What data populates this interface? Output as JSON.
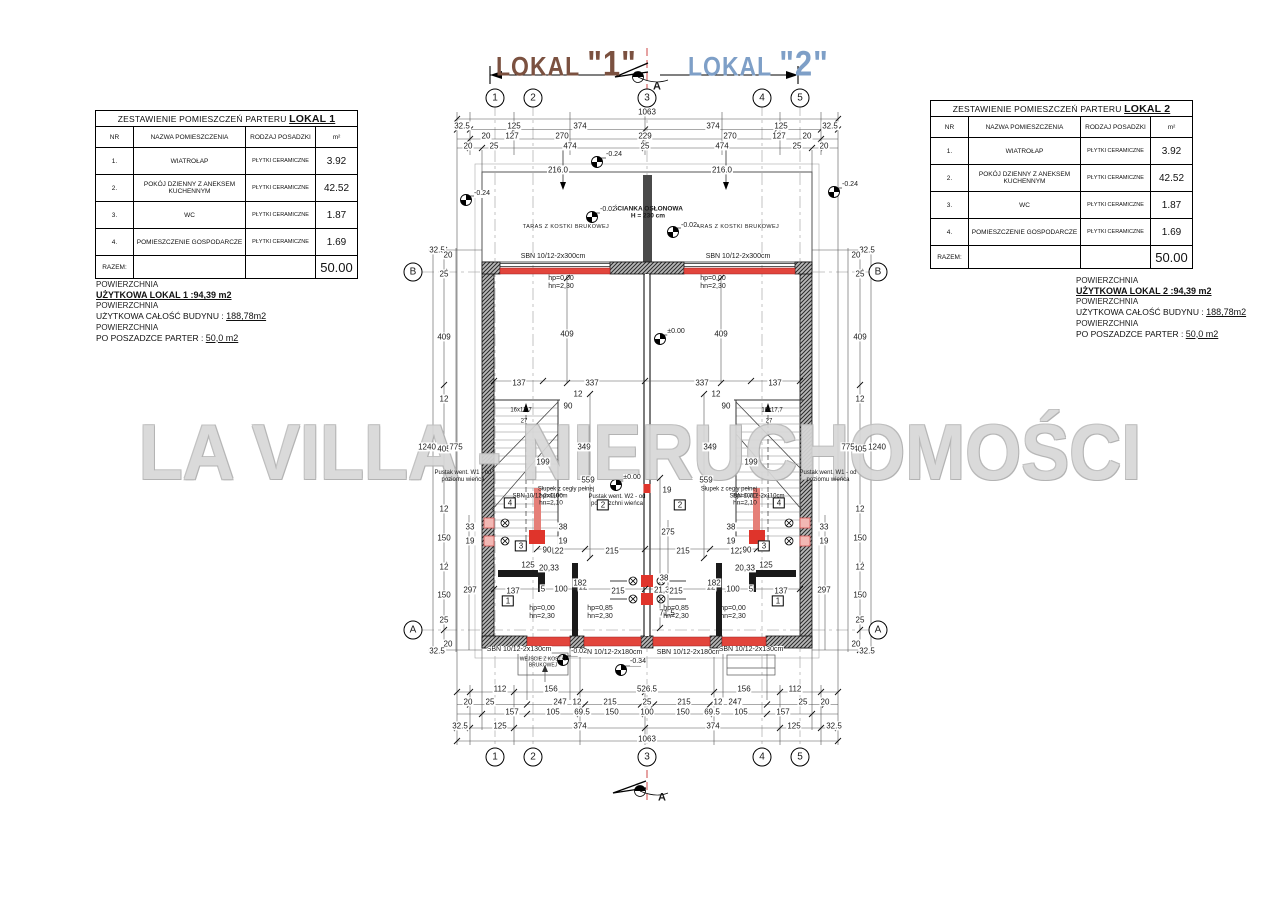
{
  "watermark": "LA VILLA - NIERUCHOMOŚCI",
  "colors": {
    "lokal1": "#7b5140",
    "lokal2": "#7e9fc7",
    "lintel_red": "#e2453c",
    "terrace_text": "#d9837d",
    "watermark_gray": "#d7d7d7"
  },
  "lokals": [
    {
      "prefix": "LOKAL",
      "num": "\"1\""
    },
    {
      "prefix": "LOKAL",
      "num": "\"2\""
    }
  ],
  "tables": [
    {
      "title": "ZESTAWIENIE POMIESZCZEŃ PARTERU ",
      "title_bold": "LOKAL 1",
      "headers": [
        "NR",
        "NAZWA POMIESZCZENIA",
        "RODZAJ POSADZKI",
        "m²"
      ],
      "rows": [
        [
          "1.",
          "WIATROŁAP",
          "PŁYTKI CERAMICZNE",
          "3.92"
        ],
        [
          "2.",
          "POKÓJ DZIENNY Z ANEKSEM KUCHENNYM",
          "PŁYTKI CERAMICZNE",
          "42.52"
        ],
        [
          "3.",
          "WC",
          "PŁYTKI CERAMICZNE",
          "1.87"
        ],
        [
          "4.",
          "POMIESZCZENIE GOSPODARCZE",
          "PŁYTKI CERAMICZNE",
          "1.69"
        ]
      ],
      "total_label": "RAZEM:",
      "total_value": "50.00"
    },
    {
      "title": "ZESTAWIENIE POMIESZCZEŃ PARTERU ",
      "title_bold": "LOKAL 2",
      "headers": [
        "NR",
        "NAZWA POMIESZCZENIA",
        "RODZAJ POSADZKI",
        "m²"
      ],
      "rows": [
        [
          "1.",
          "WIATROŁAP",
          "PŁYTKI CERAMICZNE",
          "3.92"
        ],
        [
          "2.",
          "POKÓJ DZIENNY Z ANEKSEM KUCHENNYM",
          "PŁYTKI CERAMICZNE",
          "42.52"
        ],
        [
          "3.",
          "WC",
          "PŁYTKI CERAMICZNE",
          "1.87"
        ],
        [
          "4.",
          "POMIESZCZENIE GOSPODARCZE",
          "PŁYTKI CERAMICZNE",
          "1.69"
        ]
      ],
      "total_label": "RAZEM:",
      "total_value": "50.00"
    }
  ],
  "notes": [
    {
      "p": "POWIERZCHNIA",
      "strong": "UŻYTKOWA LOKAL 1  :94,39 m2",
      "l2": "UŻYTKOWA CAŁOŚĆ BUDYNU :",
      "v2": "188,78m2",
      "l3": "PO POSZADZCE PARTER :",
      "v3": "50,0 m2"
    },
    {
      "p": "POWIERZCHNIA",
      "strong": "UŻYTKOWA LOKAL 2  :94,39 m2",
      "l2": "UŻYTKOWA CAŁOŚĆ BUDYNU :",
      "v2": "188,78m2",
      "l3": "PO POSZADZCE PARTER :",
      "v3": "50,0 m2"
    }
  ],
  "plan": {
    "labels": [
      [
        647,
        112,
        "1063",
        "d"
      ],
      [
        462,
        126,
        "32.5",
        "d"
      ],
      [
        514,
        126,
        "125",
        "d"
      ],
      [
        580,
        126,
        "374",
        "d"
      ],
      [
        713,
        126,
        "374",
        "d"
      ],
      [
        781,
        126,
        "125",
        "d"
      ],
      [
        830,
        126,
        "32.5",
        "d"
      ],
      [
        486,
        136,
        "20",
        "d"
      ],
      [
        512,
        136,
        "127",
        "d"
      ],
      [
        562,
        136,
        "270",
        "d"
      ],
      [
        645,
        136,
        "229",
        "d"
      ],
      [
        730,
        136,
        "270",
        "d"
      ],
      [
        779,
        136,
        "127",
        "d"
      ],
      [
        807,
        136,
        "20",
        "d"
      ],
      [
        468,
        146,
        "20",
        "d"
      ],
      [
        494,
        146,
        "25",
        "d"
      ],
      [
        570,
        146,
        "474",
        "d"
      ],
      [
        645,
        146,
        "25",
        "d"
      ],
      [
        722,
        146,
        "474",
        "d"
      ],
      [
        797,
        146,
        "25",
        "d"
      ],
      [
        824,
        146,
        "20",
        "d"
      ],
      [
        558,
        170,
        "216.0",
        "dv"
      ],
      [
        722,
        170,
        "216.0",
        "dv"
      ],
      [
        500,
        689,
        "112",
        "d"
      ],
      [
        551,
        689,
        "156",
        "d"
      ],
      [
        647,
        689,
        "526.5",
        "d"
      ],
      [
        744,
        689,
        "156",
        "d"
      ],
      [
        795,
        689,
        "112",
        "d"
      ],
      [
        468,
        702,
        "20",
        "d"
      ],
      [
        490,
        702,
        "25",
        "d"
      ],
      [
        560,
        702,
        "247",
        "d"
      ],
      [
        577,
        702,
        "12",
        "d"
      ],
      [
        610,
        702,
        "215",
        "d"
      ],
      [
        647,
        702,
        "25",
        "d"
      ],
      [
        684,
        702,
        "215",
        "d"
      ],
      [
        718,
        702,
        "12",
        "d"
      ],
      [
        735,
        702,
        "247",
        "d"
      ],
      [
        803,
        702,
        "25",
        "d"
      ],
      [
        825,
        702,
        "20",
        "d"
      ],
      [
        512,
        712,
        "157",
        "d"
      ],
      [
        553,
        712,
        "105",
        "d"
      ],
      [
        582,
        712,
        "69.5",
        "d"
      ],
      [
        612,
        712,
        "150",
        "d"
      ],
      [
        647,
        712,
        "100",
        "d"
      ],
      [
        683,
        712,
        "150",
        "d"
      ],
      [
        712,
        712,
        "69.5",
        "d"
      ],
      [
        741,
        712,
        "105",
        "d"
      ],
      [
        783,
        712,
        "157",
        "d"
      ],
      [
        460,
        726,
        "32.5",
        "d"
      ],
      [
        500,
        726,
        "125",
        "d"
      ],
      [
        580,
        726,
        "374",
        "d"
      ],
      [
        713,
        726,
        "374",
        "d"
      ],
      [
        794,
        726,
        "125",
        "d"
      ],
      [
        834,
        726,
        "32.5",
        "d"
      ],
      [
        647,
        739,
        "1063",
        "d"
      ],
      [
        437,
        250,
        "32.5",
        "dv"
      ],
      [
        448,
        255,
        "20",
        "dv"
      ],
      [
        444,
        274,
        "25",
        "dv"
      ],
      [
        444,
        337,
        "409",
        "dv"
      ],
      [
        444,
        399,
        "12",
        "dv"
      ],
      [
        444,
        449,
        "405",
        "dv"
      ],
      [
        444,
        509,
        "12",
        "dv"
      ],
      [
        444,
        538,
        "150",
        "dv"
      ],
      [
        444,
        567,
        "12",
        "dv"
      ],
      [
        444,
        595,
        "150",
        "dv"
      ],
      [
        444,
        620,
        "25",
        "dv"
      ],
      [
        448,
        644,
        "20",
        "dv"
      ],
      [
        437,
        651,
        "32.5",
        "dv"
      ],
      [
        427,
        447,
        "1240",
        "dv"
      ],
      [
        456,
        447,
        "775",
        "dv"
      ],
      [
        470,
        590,
        "297",
        "dv"
      ],
      [
        470,
        527,
        "33",
        "dv"
      ],
      [
        470,
        541,
        "19",
        "dv"
      ],
      [
        867,
        250,
        "32.5",
        "dv"
      ],
      [
        856,
        255,
        "20",
        "dv"
      ],
      [
        860,
        274,
        "25",
        "dv"
      ],
      [
        860,
        337,
        "409",
        "dv"
      ],
      [
        860,
        399,
        "12",
        "dv"
      ],
      [
        860,
        449,
        "405",
        "dv"
      ],
      [
        860,
        509,
        "12",
        "dv"
      ],
      [
        860,
        538,
        "150",
        "dv"
      ],
      [
        860,
        567,
        "12",
        "dv"
      ],
      [
        860,
        595,
        "150",
        "dv"
      ],
      [
        860,
        620,
        "25",
        "dv"
      ],
      [
        856,
        644,
        "20",
        "dv"
      ],
      [
        867,
        651,
        "32.5",
        "dv"
      ],
      [
        877,
        447,
        "1240",
        "dv"
      ],
      [
        848,
        447,
        "775",
        "dv"
      ],
      [
        824,
        590,
        "297",
        "dv"
      ],
      [
        824,
        527,
        "33",
        "dv"
      ],
      [
        824,
        541,
        "19",
        "dv"
      ],
      [
        519,
        383,
        "137",
        "d"
      ],
      [
        592,
        383,
        "337",
        "d"
      ],
      [
        702,
        383,
        "337",
        "d"
      ],
      [
        775,
        383,
        "137",
        "d"
      ],
      [
        567,
        334,
        "409",
        "dv"
      ],
      [
        721,
        334,
        "409",
        "dv"
      ],
      [
        588,
        480,
        "559",
        "dv"
      ],
      [
        706,
        480,
        "559",
        "dv"
      ],
      [
        584,
        447,
        "349",
        "dv"
      ],
      [
        710,
        447,
        "349",
        "dv"
      ],
      [
        543,
        462,
        "199",
        "dv"
      ],
      [
        751,
        462,
        "199",
        "dv"
      ],
      [
        568,
        406,
        "90",
        "dv"
      ],
      [
        578,
        394,
        "12",
        "dv"
      ],
      [
        726,
        406,
        "90",
        "dv"
      ],
      [
        716,
        394,
        "12",
        "dv"
      ],
      [
        563,
        527,
        "38",
        "dv"
      ],
      [
        563,
        541,
        "19",
        "dv"
      ],
      [
        731,
        527,
        "38",
        "dv"
      ],
      [
        731,
        541,
        "19",
        "dv"
      ],
      [
        667,
        490,
        "19",
        "dv"
      ],
      [
        668,
        532,
        "275",
        "dv"
      ],
      [
        664,
        578,
        "38",
        "dv"
      ],
      [
        664,
        590,
        "21,38",
        "dv"
      ],
      [
        667,
        613,
        "71,5",
        "dv"
      ],
      [
        557,
        551,
        "122",
        "d"
      ],
      [
        612,
        551,
        "215",
        "d"
      ],
      [
        683,
        551,
        "215",
        "d"
      ],
      [
        737,
        551,
        "122",
        "d"
      ],
      [
        528,
        565,
        "125",
        "d"
      ],
      [
        766,
        565,
        "125",
        "d"
      ],
      [
        549,
        568,
        "20,33",
        "dv"
      ],
      [
        745,
        568,
        "20,33",
        "dv"
      ],
      [
        513,
        591,
        "137",
        "d"
      ],
      [
        543,
        589,
        "5",
        "d"
      ],
      [
        561,
        589,
        "100",
        "d"
      ],
      [
        583,
        587,
        "12",
        "d"
      ],
      [
        781,
        591,
        "137",
        "d"
      ],
      [
        751,
        589,
        "5",
        "d"
      ],
      [
        733,
        589,
        "100",
        "d"
      ],
      [
        711,
        587,
        "12",
        "d"
      ],
      [
        580,
        583,
        "182",
        "dv"
      ],
      [
        714,
        583,
        "182",
        "dv"
      ],
      [
        547,
        550,
        "90",
        "dv"
      ],
      [
        747,
        550,
        "90",
        "dv"
      ],
      [
        618,
        591,
        "215",
        "d"
      ],
      [
        676,
        591,
        "215",
        "d"
      ],
      [
        521,
        411,
        "16x17,7",
        "stair"
      ],
      [
        524,
        422,
        "27",
        "stair"
      ],
      [
        772,
        411,
        "16x17,7",
        "stair"
      ],
      [
        769,
        422,
        "27",
        "stair"
      ],
      [
        561,
        283,
        "hp=0,00\nhn=2,30",
        "hp"
      ],
      [
        713,
        283,
        "hp=0,00\nhn=2,30",
        "hp"
      ],
      [
        542,
        613,
        "hp=0,00\nhn=2,30",
        "hp"
      ],
      [
        600,
        613,
        "hp=0,85\nhn=2,30",
        "hp"
      ],
      [
        676,
        613,
        "hp=0,85\nhn=2,30",
        "hp"
      ],
      [
        733,
        613,
        "hp=0,00\nhn=2,30",
        "hp"
      ],
      [
        551,
        500,
        "hp=0,00\nhn=2,10",
        "hpv"
      ],
      [
        745,
        500,
        "hp=0,00\nhn=2,10",
        "hpv"
      ],
      [
        463,
        477,
        "Pustak went. W1 - od\npoziomu wieńca",
        "note"
      ],
      [
        828,
        477,
        "Pustak went. W1 - od\npoziomu wieńca",
        "note"
      ],
      [
        617,
        501,
        "Pustak went. W2 - od\npowierzchni wieńca",
        "note"
      ],
      [
        540,
        497,
        "SBN 10/12-2x110cm",
        "note"
      ],
      [
        757,
        497,
        "SBN 10/12-2x110cm",
        "note"
      ],
      [
        566,
        490,
        "Słupek z cegły pełnej",
        "note"
      ],
      [
        729,
        490,
        "Słupek z cegły pełnej",
        "note"
      ],
      [
        566,
        227,
        "TARAS Z KOSTKI BRUKOWEJ",
        "red"
      ],
      [
        736,
        227,
        "TARAS Z KOSTKI BRUKOWEJ",
        "red"
      ],
      [
        648,
        213,
        "ŚCIANKA OSŁONOWA\nH = 230 cm",
        "redv"
      ],
      [
        543,
        663,
        "WEJŚCIE Z KOSTKI\nBRUKOWEJ",
        "redbox"
      ],
      [
        553,
        257,
        "SBN 10/12-2x300cm",
        "sbn"
      ],
      [
        738,
        257,
        "SBN 10/12-2x300cm",
        "sbn"
      ],
      [
        519,
        650,
        "SBN 10/12-2x130cm",
        "sbn"
      ],
      [
        610,
        653,
        "SBN 10/12-2x180cm",
        "sbn"
      ],
      [
        689,
        653,
        "SBN 10/12-2x180cm",
        "sbn"
      ],
      [
        751,
        650,
        "SBN 10/12-2x130cm",
        "sbn"
      ],
      [
        614,
        155,
        "-0.24",
        "lvl"
      ],
      [
        482,
        194,
        "-0.24",
        "lvl"
      ],
      [
        850,
        185,
        "-0.24",
        "lvl"
      ],
      [
        608,
        210,
        "-0.02",
        "lvl"
      ],
      [
        689,
        226,
        "-0.02",
        "lvl"
      ],
      [
        676,
        332,
        "±0.00",
        "lvl"
      ],
      [
        632,
        478,
        "±0.00",
        "lvl"
      ],
      [
        579,
        652,
        "-0.02",
        "lvl"
      ],
      [
        638,
        662,
        "-0.34",
        "lvl"
      ],
      [
        495,
        98,
        "1",
        "bub"
      ],
      [
        533,
        98,
        "2",
        "bub"
      ],
      [
        647,
        98,
        "3",
        "bub"
      ],
      [
        762,
        98,
        "4",
        "bub"
      ],
      [
        800,
        98,
        "5",
        "bub"
      ],
      [
        495,
        757,
        "1",
        "bub"
      ],
      [
        533,
        757,
        "2",
        "bub"
      ],
      [
        647,
        757,
        "3",
        "bub"
      ],
      [
        762,
        757,
        "4",
        "bub"
      ],
      [
        800,
        757,
        "5",
        "bub"
      ],
      [
        413,
        272,
        "B",
        "bub"
      ],
      [
        878,
        272,
        "B",
        "bub"
      ],
      [
        413,
        630,
        "A",
        "bub"
      ],
      [
        878,
        630,
        "A",
        "bub"
      ],
      [
        657,
        87,
        "A",
        "sec"
      ],
      [
        662,
        798,
        "A",
        "sec"
      ],
      [
        510,
        503,
        "4",
        "room"
      ],
      [
        779,
        503,
        "4",
        "room"
      ],
      [
        603,
        505,
        "2",
        "room"
      ],
      [
        680,
        505,
        "2",
        "room"
      ],
      [
        521,
        546,
        "3",
        "room"
      ],
      [
        764,
        546,
        "3",
        "room"
      ],
      [
        508,
        601,
        "1",
        "room"
      ],
      [
        778,
        601,
        "1",
        "room"
      ]
    ]
  }
}
